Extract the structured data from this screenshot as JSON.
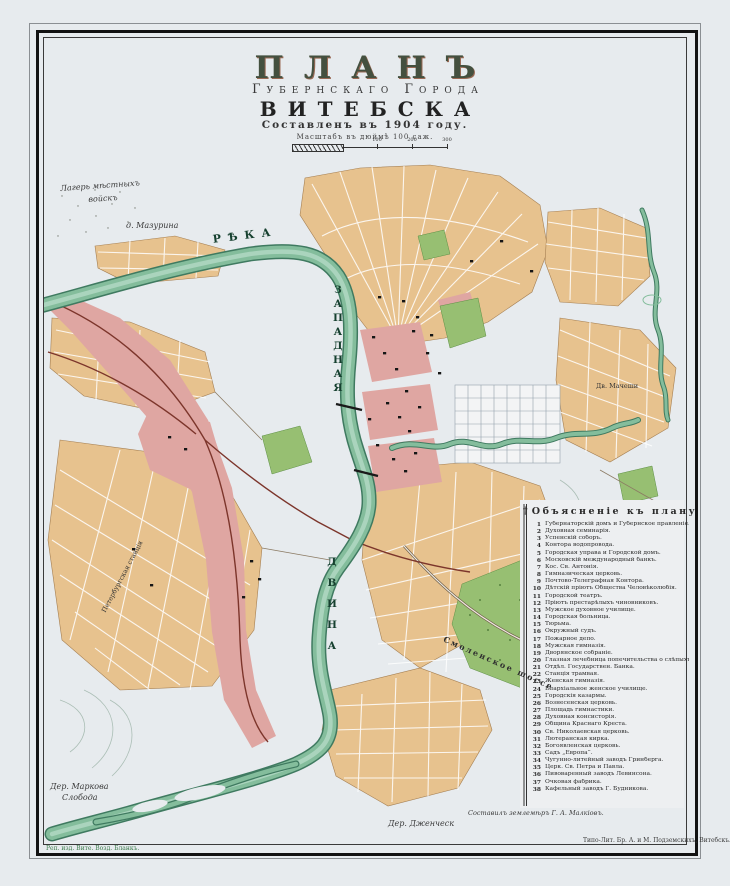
{
  "title": {
    "plan": "ПЛАНЪ",
    "subtitle": "Губернскаго Города",
    "city": "ВИТЕБСКА",
    "compiled": "Составленъ въ 1904 году.",
    "scale_caption": "Масштабъ въ дюймѣ 100 саж.",
    "scale_ticks": [
      "100",
      "200",
      "300"
    ]
  },
  "legend": {
    "ornament": "†",
    "title": "Объясненіе къ плану",
    "items": [
      "Губернаторскій домъ и Губернское правленіе.",
      "Духовная семинарія.",
      "Успенскій соборъ.",
      "Контора водопровода.",
      "Городская управа и Городской домъ.",
      "Московскій международный банкъ.",
      "Кос. Св. Антонія.",
      "Гимназическая церковь.",
      "Почтово-Телеграфная Контора.",
      "Дѣтскій пріютъ Общества Человѣколюбія.",
      "Городской театръ.",
      "Пріютъ престарѣлыхъ чиновниковъ.",
      "Мужское духовное училище.",
      "Городская больница.",
      "Тюрьма.",
      "Окружный судъ.",
      "Пожарное депо.",
      "Мужская гимназія.",
      "Дворянское собраніе.",
      "Глазная лечебница попечительства о слѣпыхъ.",
      "Отдѣл. Государствен. Банка.",
      "Станція трамвая.",
      "Женская гимназія.",
      "Епархіальное женское училище.",
      "Городскія казармы.",
      "Вознесенская церковь.",
      "Площадь гимнастики.",
      "Духовная консисторія.",
      "Община Краснаго Креста.",
      "Св. Николаевская церковь.",
      "Лютеранская кирка.",
      "Богоявленская церковь.",
      "Садъ „Европа“.",
      "Чугунно-литейный заводъ Гринберга.",
      "Церк. Св. Петра и Павла.",
      "Пивоваренный заводъ Левинсона.",
      "Очковая фабрика.",
      "Кафельный заводъ Г. Будникова."
    ]
  },
  "map_labels": [
    {
      "text": "Лагерь мѣстныхъ",
      "x": 60,
      "y": 184,
      "rot": -4,
      "cls": "cursive"
    },
    {
      "text": "войскъ",
      "x": 88,
      "y": 195,
      "rot": -4,
      "cls": "cursive"
    },
    {
      "text": "д. Мазурина",
      "x": 126,
      "y": 221,
      "rot": 0,
      "cls": "cursive"
    },
    {
      "text": "РѢКА",
      "x": 212,
      "y": 233,
      "rot": -7,
      "cls": "river-h"
    },
    {
      "text": "ЗАПАДНАЯ",
      "x": 333,
      "y": 283,
      "rot": 0,
      "cls": "vstack",
      "gap": 4
    },
    {
      "text": "ДВИНА",
      "x": 327,
      "y": 552,
      "rot": 0,
      "cls": "vstack",
      "gap": 11
    },
    {
      "text": "Дв. Мачеши",
      "x": 596,
      "y": 382,
      "rot": 0,
      "cls": "tiny"
    },
    {
      "text": "Смоленское шоссе",
      "x": 446,
      "y": 634,
      "rot": 24,
      "cls": "road"
    },
    {
      "text": "Петербургская станція",
      "x": 100,
      "y": 610,
      "rot": -62,
      "cls": "tiny"
    },
    {
      "text": "Дер. Маркова",
      "x": 50,
      "y": 782,
      "rot": 0,
      "cls": "cursive"
    },
    {
      "text": "Слобода",
      "x": 62,
      "y": 793,
      "rot": 0,
      "cls": "cursive"
    },
    {
      "text": "Дер. Дженческ",
      "x": 388,
      "y": 819,
      "rot": 0,
      "cls": "cursive"
    }
  ],
  "credits": {
    "surveyor": "Составилъ землемѣръ Г. А. Малкіовъ.",
    "printer": "Типо-Лит. Бр. А. и М. Подземскихъ, Витебскъ.",
    "stamp": "Реп. изд. Вите. Возд. Бланкъ."
  },
  "palette": {
    "paper": "#e7ebee",
    "tan": "#e7c28e",
    "pink": "#dfa6a2",
    "river": "#84bd9c",
    "riverEdge": "#3f7a60",
    "park": "#97bf72",
    "rail": "#7c352b",
    "stamp": "#3d7d4d"
  }
}
